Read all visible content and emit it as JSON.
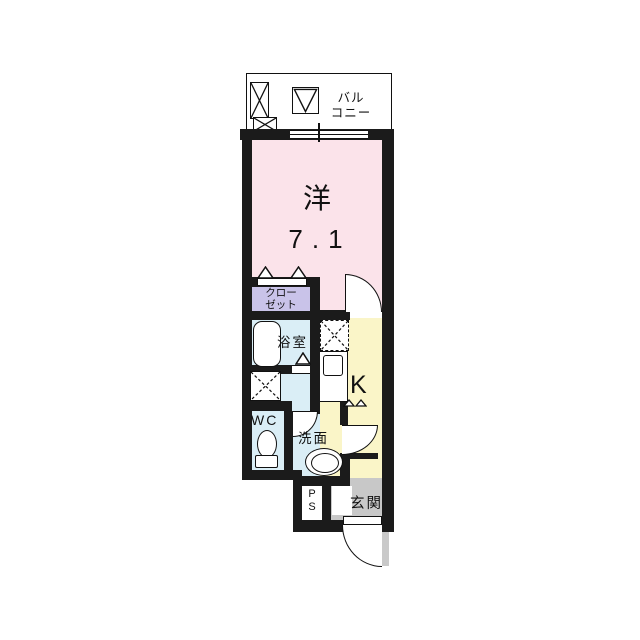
{
  "plan": {
    "type": "apartment-floor-plan",
    "colors": {
      "wall": "#1b1b1b",
      "western_room": "#fbe3ea",
      "closet": "#c9c3e9",
      "wet_area": "#daeef6",
      "kitchen": "#faf5c8",
      "entrance": "#c8c8c8"
    },
    "rooms": {
      "balcony": {
        "line1": "バル",
        "line2": "コニー"
      },
      "western": {
        "label": "洋",
        "size": "7.1"
      },
      "closet": {
        "line1": "クロー",
        "line2": "ゼット"
      },
      "bath": {
        "label": "浴室"
      },
      "wc": {
        "label": "WC"
      },
      "washroom": {
        "label": "洗面"
      },
      "kitchen": {
        "label": "K"
      },
      "pipe_space": {
        "line1": "P",
        "line2": "S"
      },
      "entrance": {
        "label": "玄関"
      }
    }
  }
}
